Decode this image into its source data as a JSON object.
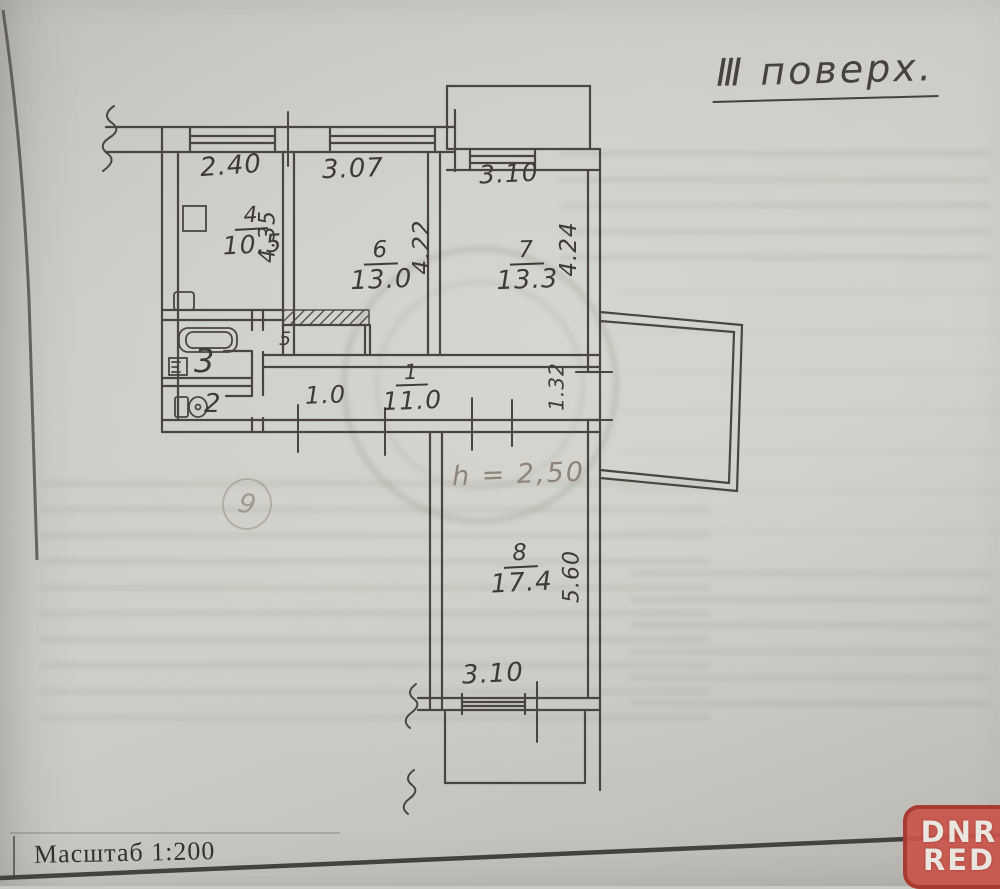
{
  "document": {
    "floor_title": "Ⅲ поверх.",
    "scale_label": "Масштаб 1:200",
    "height_note": "h = 2,50",
    "pencil_note": "9"
  },
  "rooms": {
    "kitchen": {
      "number": "4",
      "area": "10.5"
    },
    "living6": {
      "number": "6",
      "area": "13.0"
    },
    "living7": {
      "number": "7",
      "area": "13.3"
    },
    "hall": {
      "number": "1",
      "area": "11.0"
    },
    "bathroom": {
      "number": "3"
    },
    "wc": {
      "number": "2"
    },
    "closet": {
      "number": "5"
    },
    "room8": {
      "number": "8",
      "area": "17.4"
    }
  },
  "dimensions": {
    "kitchen_width": "2.40",
    "kitchen_depth": "4.35",
    "living6_width": "3.07",
    "living6_depth": "4.22",
    "living7_width": "3.10",
    "living7_depth": "4.24",
    "hall_width": "1.0",
    "balcony_opening": "1.32",
    "room8_width": "3.10",
    "room8_depth": "5.60"
  },
  "watermark": {
    "line1": "DNR",
    "line2": "RED"
  },
  "colors": {
    "ink": "#3e3b35",
    "pencil": "#8d8579",
    "badge_red": "#c8544a",
    "paper": "#c9c8c2"
  }
}
